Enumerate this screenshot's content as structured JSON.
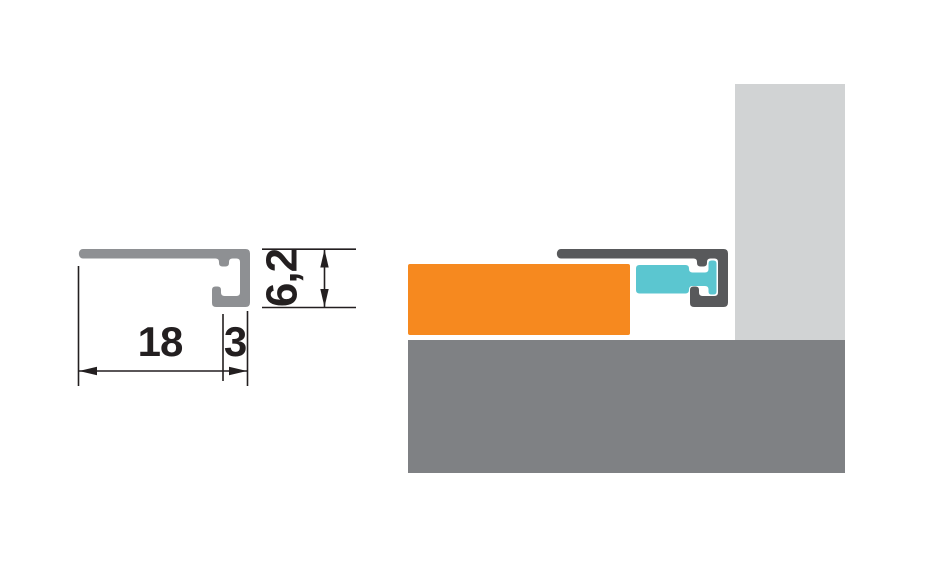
{
  "drawing": {
    "profile_view": {
      "dim_width": "18",
      "dim_lip": "3",
      "dim_height": "6,2"
    }
  },
  "colors": {
    "background": "#ffffff",
    "profile_section_gray": "#8e9093",
    "profile_installed_gray": "#58595b",
    "tile_orange": "#f6891f",
    "insert_cyan": "#5bc6d0",
    "wall_light_gray": "#d1d3d4",
    "floor_gray": "#7f8184",
    "dimension_ink": "#231f20"
  }
}
